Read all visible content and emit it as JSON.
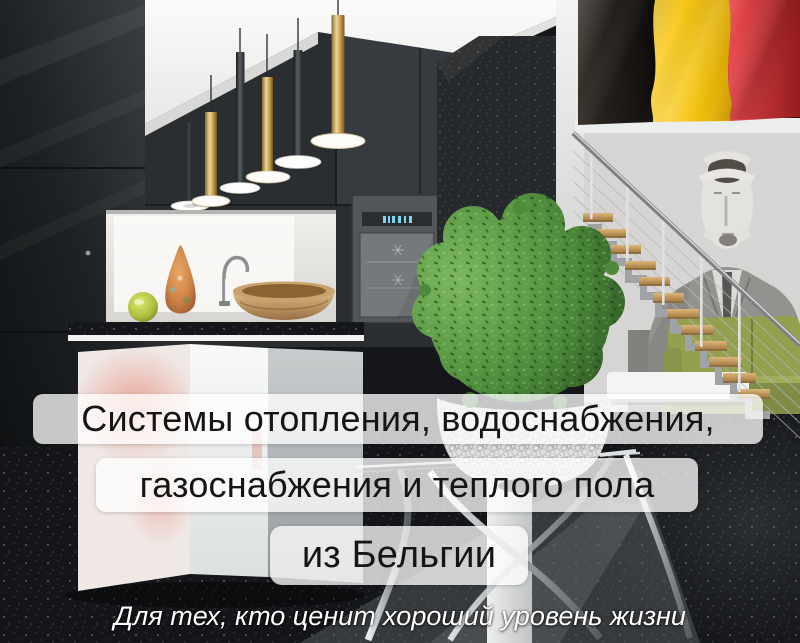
{
  "poster": {
    "headline_lines": [
      {
        "text": "Системы отопления, водоснабжения,"
      },
      {
        "text": "газоснабжения и теплого пола"
      },
      {
        "text": "из Бельгии"
      }
    ],
    "tagline": {
      "text": "Для тех, кто ценит хороший уровень жизни"
    },
    "flag": {
      "icon": "belgium-flag",
      "colors": {
        "black": "#1b1512",
        "yellow": "#f2c411",
        "red": "#c8282c"
      }
    },
    "palette": {
      "headline_box_bg": "rgba(255,255,255,0.76)",
      "headline_text": "#151515",
      "tagline_text": "#ffffff",
      "pendant_gold": "#d2aa5c",
      "plant_green": "#4c8a3a",
      "sofa_green": "#93a14e",
      "stair_wood": "#c79d63",
      "floor_granite": "#141619"
    }
  }
}
